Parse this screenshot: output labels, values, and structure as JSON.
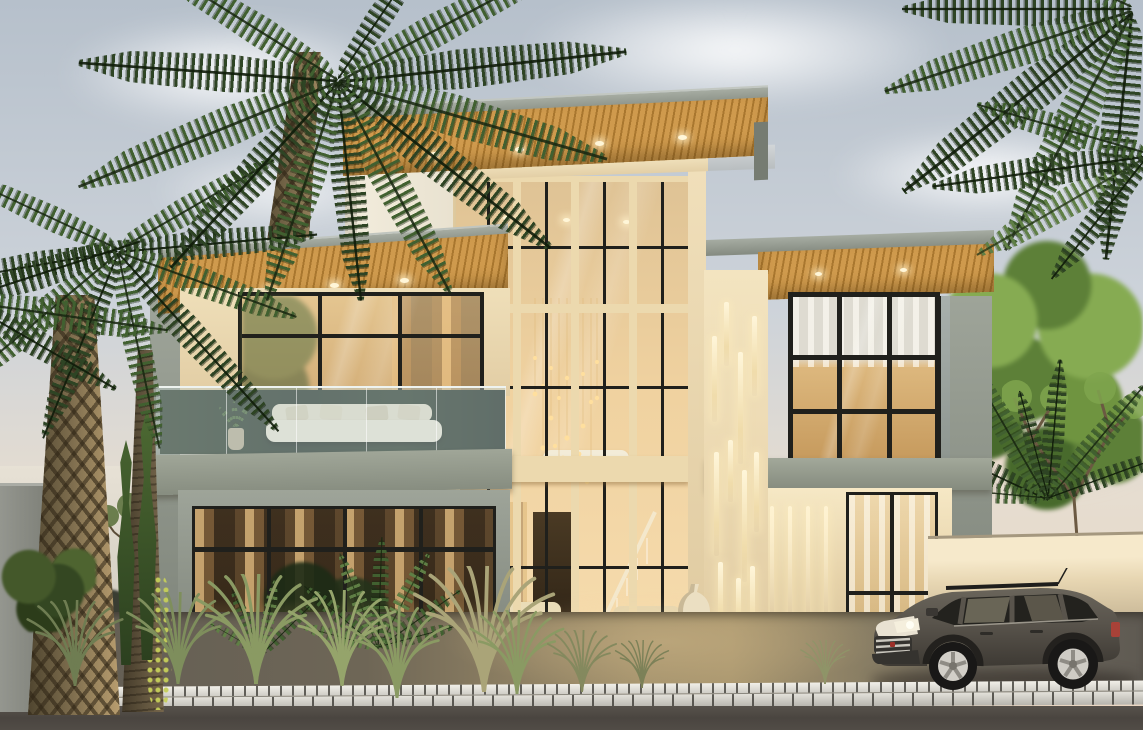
{
  "meta": {
    "type": "architectural-render",
    "description": "Dusk exterior rendering of a modern two-storey villa with a triple-height glass atrium, wood-soffit cantilever roofs with downlights, vertical LED wall slits, glass balcony, palm trees, tropical landscaping, boundary walls, cobblestone kerb and a dark grey SUV parked at the right"
  },
  "palette": {
    "sky_top": "#b6c0cb",
    "sky_mid": "#cdd3da",
    "sky_low": "#e6ddd0",
    "horizon_warm": "#ead5c0",
    "horizon_pale": "#e7e1d5",
    "sage_light": "#a3a99c",
    "sage": "#99a091",
    "sage_dark": "#7e8479",
    "cream": "#efe2c0",
    "cream_lit": "#f6e8c5",
    "cream_shade": "#d9c7a2",
    "wood_light": "#cf9a4d",
    "wood_dark": "#a9772f",
    "frame_dark": "#20201c",
    "mullion_cream": "#ecd9ae",
    "glass_top": "#dfc395",
    "glass_warm": "#f0d2a0",
    "glass_bright": "#f6dcae",
    "glass_deep": "#c2955c",
    "interior_dark": "#31271a",
    "led": "#fff3d0",
    "chand_gold": "#ffdf9e",
    "palm_dark": "#2e4424",
    "palm_mid": "#416030",
    "palm_light": "#5f7f45",
    "trunk_light": "#a38c63",
    "trunk_dark": "#4f452f",
    "foliage_a": "#86ab52",
    "foliage_b": "#5d8038",
    "foliage_c": "#486a2c",
    "cypress_a": "#46622f",
    "cypress_b": "#2c401f",
    "treeline": "#3a3d32",
    "hedge": "#344722",
    "vine": "#c6cf5a",
    "grass_green": "#8a9a63",
    "grass_dry": "#aaa478",
    "ground_warm": "#a6946e",
    "ground_gray": "#615c54",
    "curb_light": "#e6e4dd",
    "curb_dark": "#8a887f",
    "road": "#4a4540",
    "wall_right_lit": "#f6e9cb",
    "wall_right": "#dcc9a4",
    "wall_gray": "#90928b",
    "car_body": "#59544c",
    "car_dark": "#3b3833",
    "car_glass": "#23221e",
    "car_trim": "#cac7be",
    "car_light": "#f5efdd",
    "taillight": "#a84238",
    "step_stone": "#e2d7ba",
    "vase": "#ebdfc2"
  },
  "scene": {
    "objects": [
      {
        "name": "villa",
        "label": "modern two-storey villa with glass atrium"
      },
      {
        "name": "atrium-chandelier",
        "label": "cascading bead chandelier"
      },
      {
        "name": "roof-downlights",
        "label": "recessed soffit downlights"
      },
      {
        "name": "led-wall-slits",
        "label": "vertical LED slit lights"
      },
      {
        "name": "balcony",
        "label": "glass-balustrade balcony with white sofa"
      },
      {
        "name": "entry-steps",
        "label": "stone steps with LED strips"
      },
      {
        "name": "suv",
        "label": "dark grey SUV parked by boundary wall"
      },
      {
        "name": "palms",
        "label": "date palms and tropical planting"
      },
      {
        "name": "street",
        "label": "cobblestone kerb and asphalt road"
      }
    ]
  }
}
